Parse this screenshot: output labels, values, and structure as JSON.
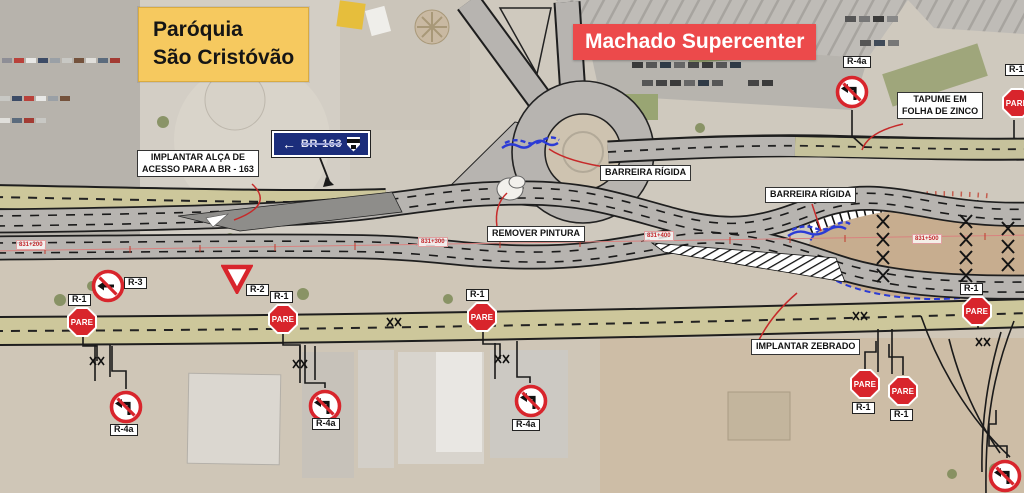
{
  "places": {
    "paroquia_line1": "Paróquia",
    "paroquia_line2": "São Cristóvão",
    "supercenter": "Machado Supercenter"
  },
  "annotations": {
    "implantar_alca_line1": "IMPLANTAR ALÇA DE",
    "implantar_alca_line2": "ACESSO PARA A BR - 163",
    "barreira_rigida": "BARREIRA RÍGIDA",
    "remover_pintura": "REMOVER PINTURA",
    "tapume_line1": "TAPUME EM",
    "tapume_line2": "FOLHA DE ZINCO",
    "implantar_zebrado": "IMPLANTAR ZEBRADO"
  },
  "route_sign": {
    "arrow": "←",
    "route": "BR-163"
  },
  "signs": {
    "pare": "PARE",
    "r1": "R-1",
    "r2": "R-2",
    "r3": "R-3",
    "r4a": "R-4a"
  },
  "stations": {
    "s200": "831+200",
    "s300": "831+300",
    "s400": "831+400",
    "s500": "831+500"
  },
  "colors": {
    "paroquia_bg": "#F6C95F",
    "supercenter_bg": "#EC4A4B",
    "pare_red": "#D8252C",
    "road_khaki": "#CDC79B",
    "road_gray": "#B7B4B0",
    "barrier_blue": "#2B3BD6",
    "leader_red": "#C62A2A",
    "route_plate_blue": "#1B2D7B"
  }
}
